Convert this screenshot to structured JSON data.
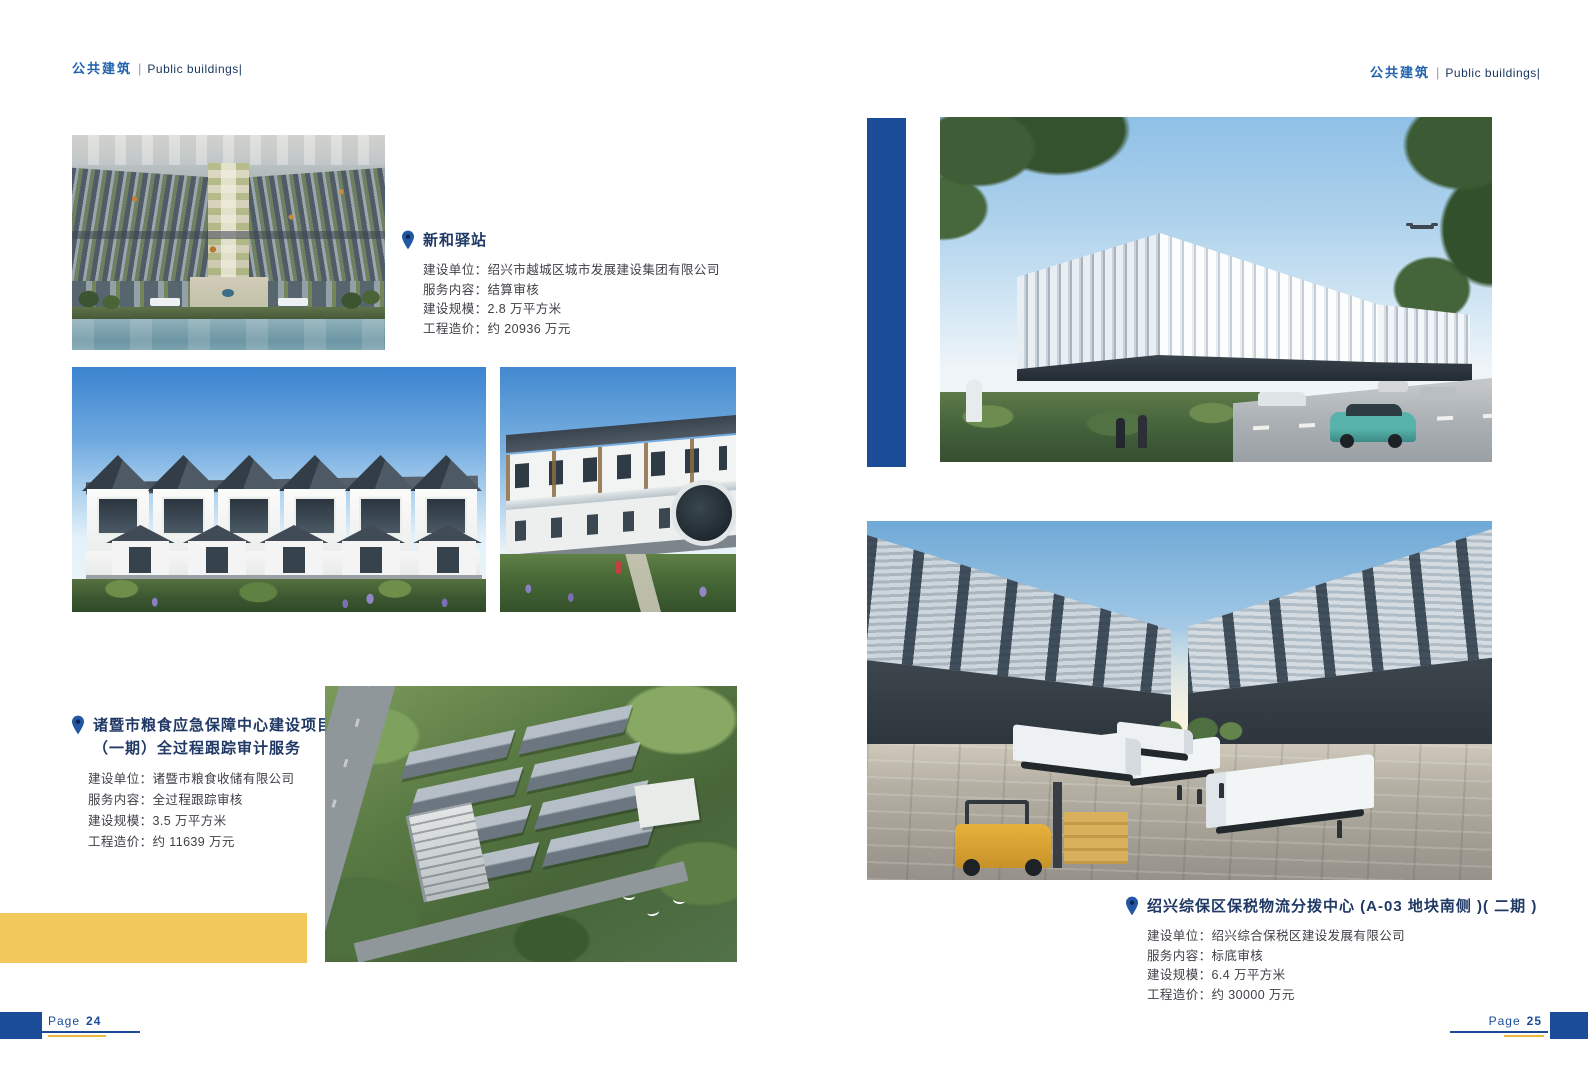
{
  "document": {
    "kind": "brochure-spread"
  },
  "colors": {
    "primary_blue": "#1b4c97",
    "header_blue": "#2063ac",
    "header_dark": "#17365d",
    "title_navy": "#1f3864",
    "body_text": "#3f4147",
    "accent_yellow": "#f2c75c",
    "footer_yellow": "#e9b83a"
  },
  "left_page": {
    "header": {
      "zh": "公共建筑",
      "divider": "|",
      "en": "Public buildings|"
    },
    "footer": {
      "label": "Page",
      "number": "24"
    }
  },
  "right_page": {
    "header": {
      "zh": "公共建筑",
      "divider": "|",
      "en": "Public buildings|"
    },
    "footer": {
      "label": "Page",
      "number": "25"
    }
  },
  "projects": [
    {
      "title": "新和驿站",
      "fields": [
        {
          "label": "建设单位：",
          "value": "绍兴市越城区城市发展建设集团有限公司"
        },
        {
          "label": "服务内容：",
          "value": "结算审核"
        },
        {
          "label": "建设规模：",
          "value": "2.8 万平方米"
        },
        {
          "label": "工程造价：",
          "value": "约 20936 万元"
        }
      ]
    },
    {
      "title": "诸暨市粮食应急保障中心建设项目（一期）全过程跟踪审计服务",
      "fields": [
        {
          "label": "建设单位：",
          "value": "诸暨市粮食收储有限公司"
        },
        {
          "label": "服务内容：",
          "value": "全过程跟踪审核"
        },
        {
          "label": "建设规模：",
          "value": "3.5 万平方米"
        },
        {
          "label": "工程造价：",
          "value": "约 11639 万元"
        }
      ]
    },
    {
      "title": "绍兴综保区保税物流分拨中心 (A-03 地块南侧 )( 二期 )",
      "fields": [
        {
          "label": "建设单位：",
          "value": "绍兴综合保税区建设发展有限公司"
        },
        {
          "label": "服务内容：",
          "value": "标底审核"
        },
        {
          "label": "建设规模：",
          "value": "6.4 万平方米"
        },
        {
          "label": "工程造价：",
          "value": "约 30000 万元"
        }
      ]
    }
  ],
  "icons": {
    "project_marker": "map-pin"
  }
}
